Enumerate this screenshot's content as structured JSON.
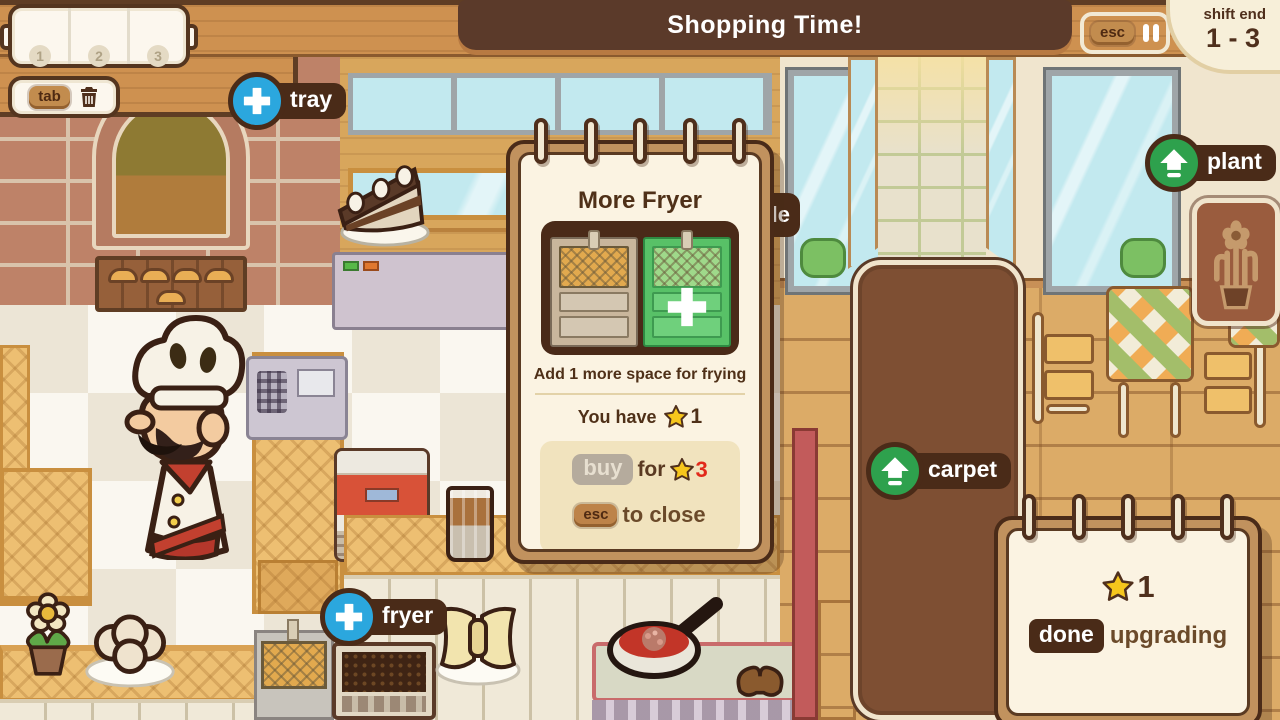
{
  "hud": {
    "tray_panel": {
      "slots": [
        "1",
        "2",
        "3"
      ]
    },
    "tab_button": {
      "label": "tab"
    },
    "banner": {
      "title": "Shopping Time!"
    },
    "pause_box": {
      "esc_label": "esc"
    },
    "shift_card": {
      "label": "shift end",
      "range": "1 - 3"
    },
    "shop_buttons": {
      "tray": {
        "label": "tray"
      },
      "fryer": {
        "label": "fryer"
      },
      "plant": {
        "label": "plant"
      },
      "carpet": {
        "label": "carpet"
      },
      "table_partial": {
        "label": "le"
      }
    }
  },
  "upgrade_modal": {
    "title": "More Fryer",
    "description": "Add 1 more space for frying",
    "you_have_label": "You have",
    "owned_stars": "1",
    "buy_label": "buy",
    "for_label": "for",
    "cost_stars": "3",
    "esc_label": "esc",
    "close_label": "to close"
  },
  "done_panel": {
    "reward_stars": "1",
    "done_label": "done",
    "upgrading_label": "upgrading"
  },
  "icons": {
    "plus": "+",
    "upgrade_arrow": "up-arrow",
    "pause": "pause-bars",
    "trash": "trash-can",
    "star": "star"
  },
  "colors": {
    "banner_brown": "#5B3A2A",
    "paper_cream": "#FBF3E2",
    "accent_blue": "#2BA7DE",
    "accent_green": "#2EA14D",
    "star_yellow": "#F6C61C",
    "cost_red": "#E2291B",
    "dark_brown": "#4F2F1C",
    "carpet_brown": "#7E4F33"
  }
}
